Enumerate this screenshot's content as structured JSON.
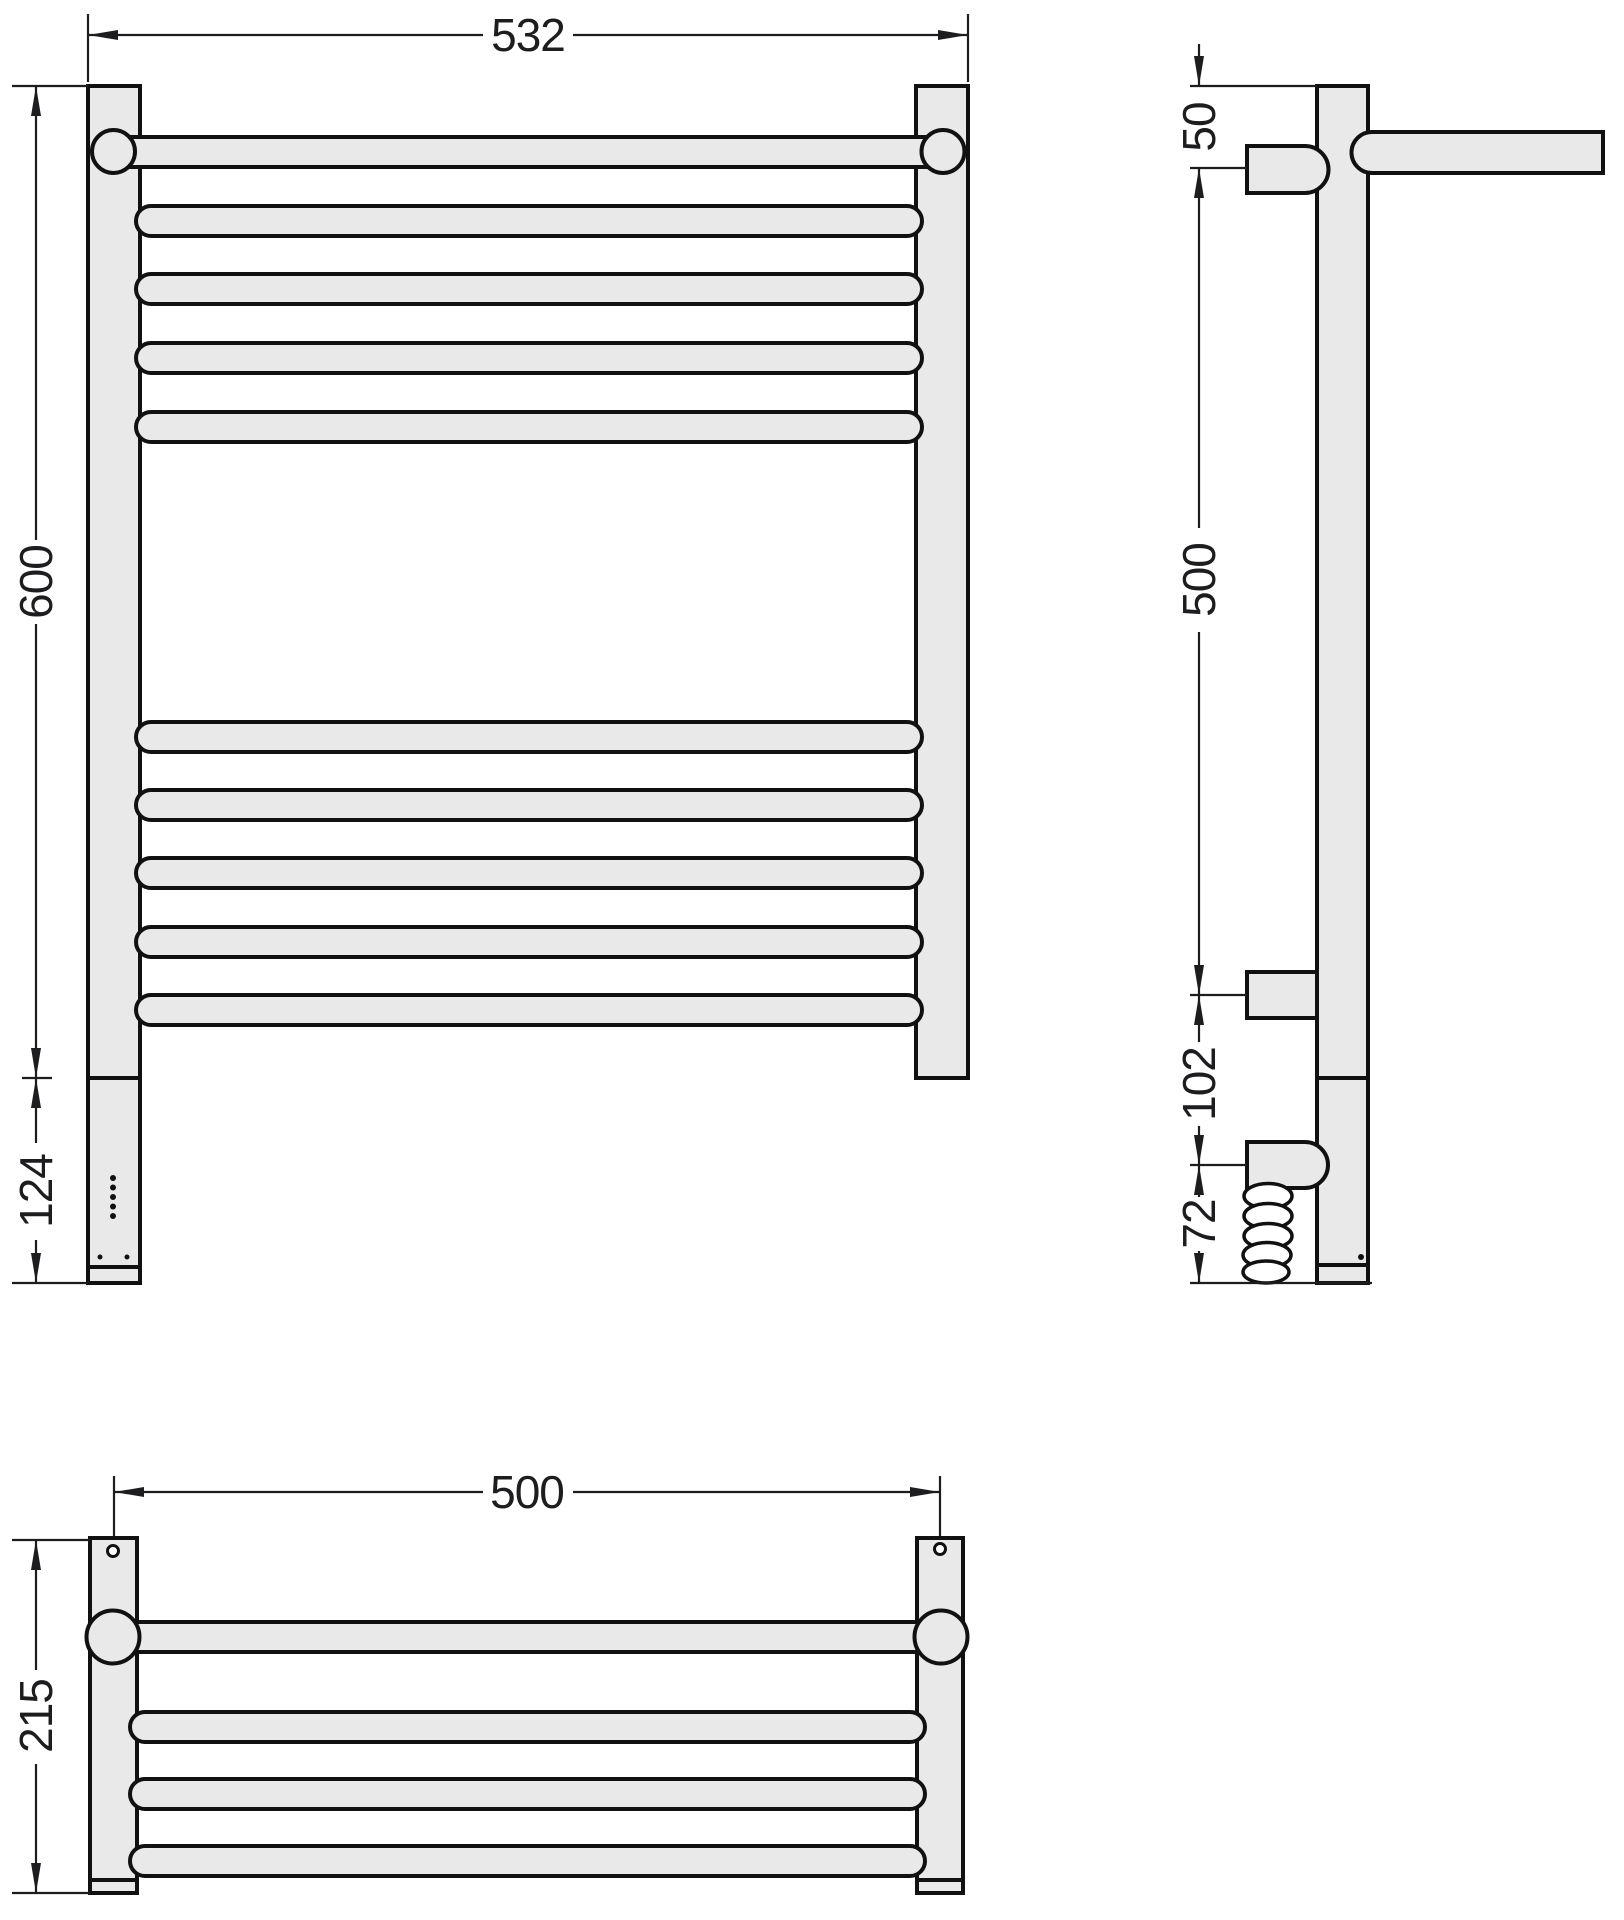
{
  "drawing_title": "heated-towel-rail-dimension-drawing",
  "colors": {
    "background": "#ffffff",
    "part_fill": "#e9e9e9",
    "outline": "#111111",
    "dimension": "#1d1d1f"
  },
  "front": {
    "width_label": "532",
    "height_label": "600",
    "bottom_label": "124",
    "rung_count_upper": 5,
    "rung_count_lower": 5,
    "indicator_dot_count": 5
  },
  "side": {
    "top_offset_label": "50",
    "span_label": "500",
    "gap_label": "102",
    "cable_label": "72"
  },
  "top": {
    "width_label": "500",
    "depth_label": "215",
    "rung_count": 4
  }
}
